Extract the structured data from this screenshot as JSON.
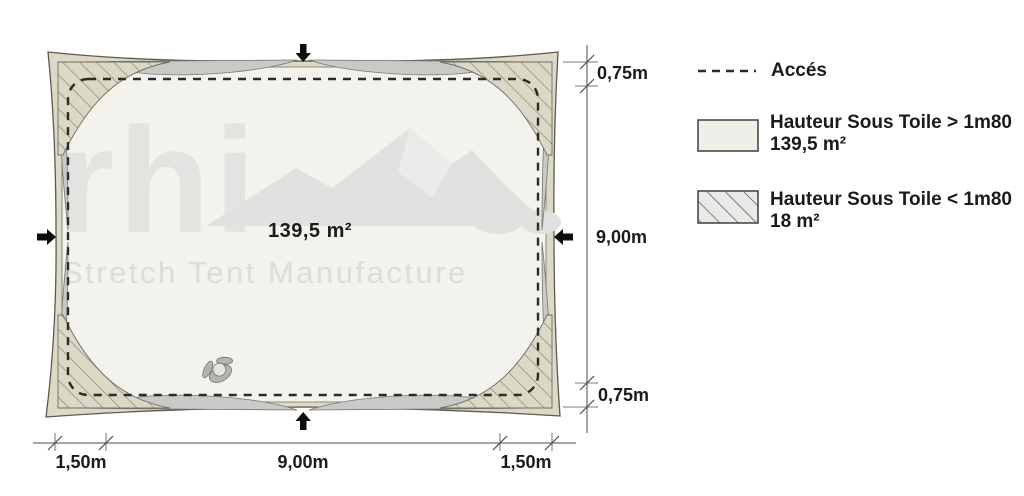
{
  "plan": {
    "area_label": "139,5 m²",
    "watermark_logo": "rhi",
    "watermark_tagline": "Stretch Tent Manufacture",
    "dim_right_top": "0,75m",
    "dim_right_middle": "9,00m",
    "dim_right_bottom": "0,75m",
    "dim_bottom_left": "1,50m",
    "dim_bottom_center": "9,00m",
    "dim_bottom_right": "1,50m"
  },
  "legend": {
    "access_label": "Accés",
    "over": {
      "label": "Hauteur Sous Toile > 1m80",
      "area": "139,5 m²"
    },
    "under": {
      "label": "Hauteur Sous Toile < 1m80",
      "area": "18 m²"
    }
  },
  "colors": {
    "fabric_beige": "#dcd9c6",
    "hatch_line": "#8a887a",
    "edge_gray": "#c9c9c7",
    "interior_cream": "#f3f2ed",
    "legend_over_fill": "#efeee9",
    "legend_under_fill": "#e9e9e7",
    "ink": "#1b1b1b",
    "dimension_line": "#4e4d49",
    "watermark_gray": "#e3e3e1"
  }
}
